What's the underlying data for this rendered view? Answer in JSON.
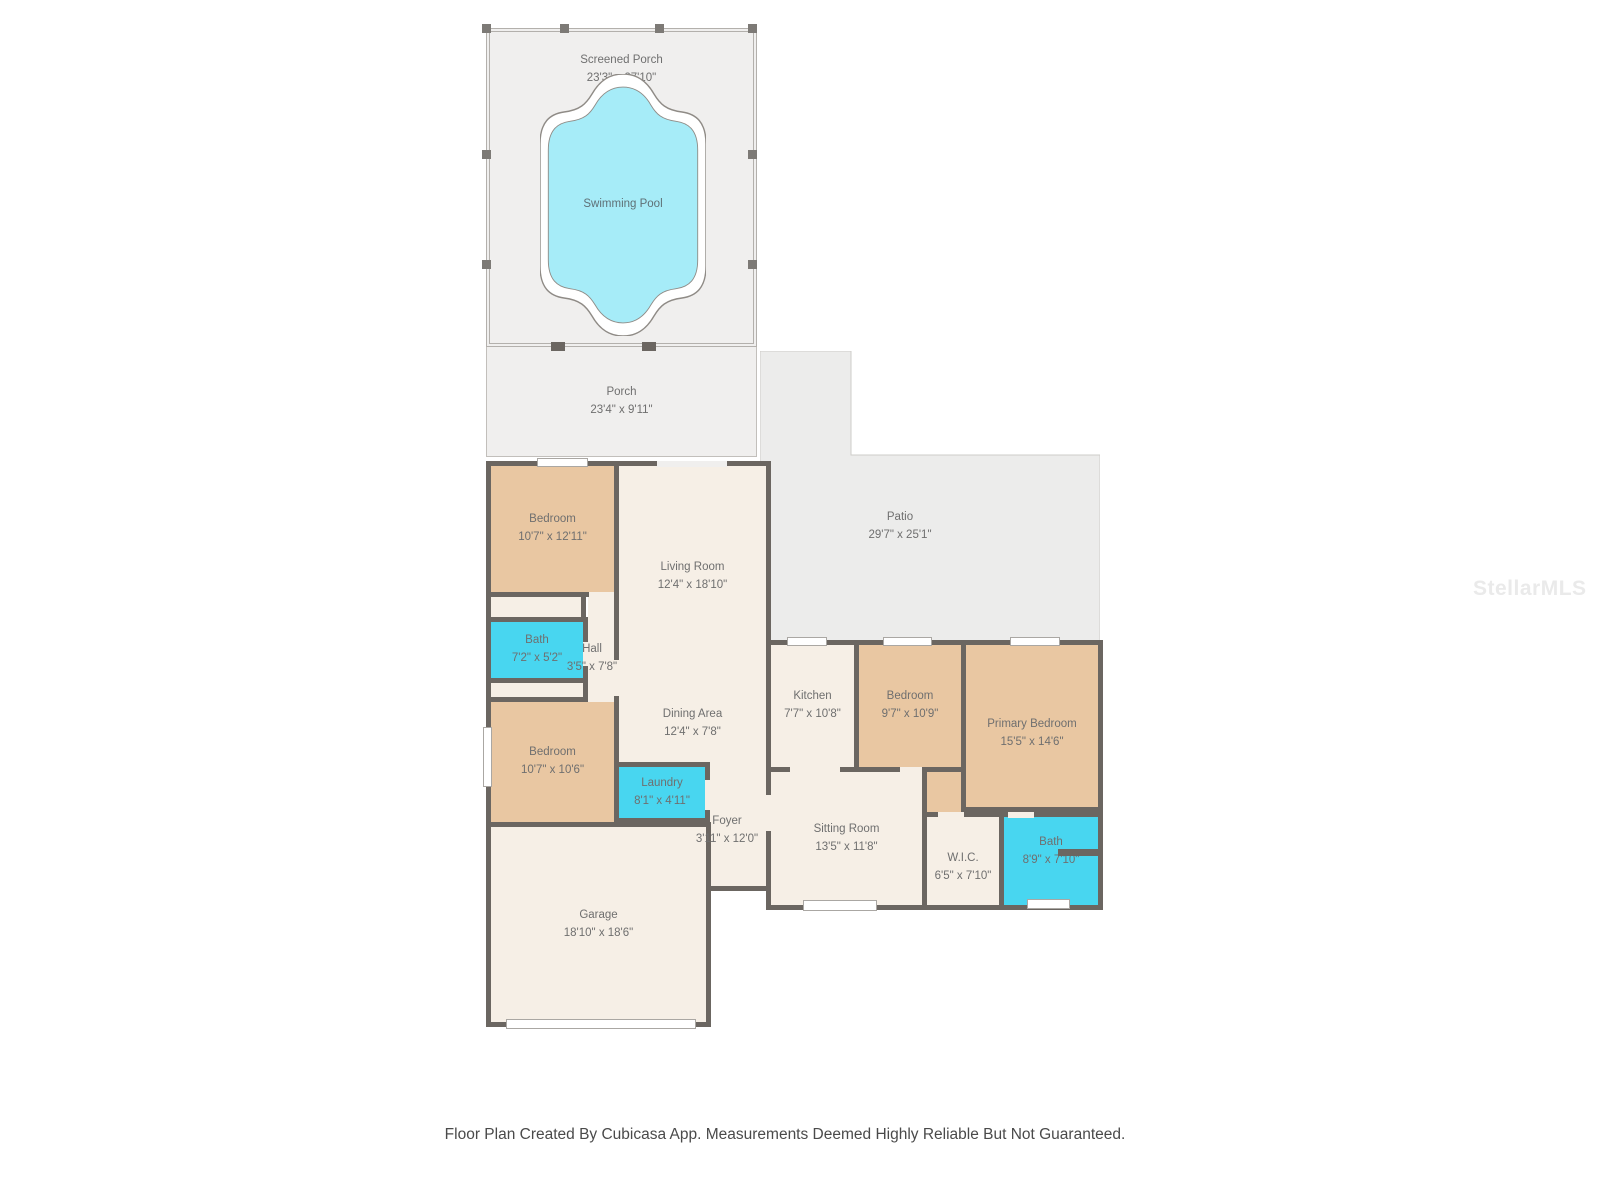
{
  "title": "Floor Plan",
  "palette": {
    "wall": "#6b6661",
    "bedroom_fill": "#e9c7a2",
    "floor_fill": "#f6efe6",
    "wet_room_fill": "#48d6f0",
    "pool_fill": "#a6ecf8",
    "outdoor_fill": "#ececeb",
    "porch_fill": "#f0efee"
  },
  "rooms": {
    "screened_porch": {
      "name": "Screened Porch",
      "dims": "23'3\" x 27'10\""
    },
    "swimming_pool": {
      "name": "Swimming Pool",
      "dims": ""
    },
    "porch": {
      "name": "Porch",
      "dims": "23'4\" x 9'11\""
    },
    "patio": {
      "name": "Patio",
      "dims": "29'7\" x 25'1\""
    },
    "bedroom_top": {
      "name": "Bedroom",
      "dims": "10'7\" x 12'11\""
    },
    "living_room": {
      "name": "Living Room",
      "dims": "12'4\" x 18'10\""
    },
    "bath_1": {
      "name": "Bath",
      "dims": "7'2\" x 5'2\""
    },
    "hall": {
      "name": "Hall",
      "dims": "3'5\" x 7'8\""
    },
    "bedroom_mid": {
      "name": "Bedroom",
      "dims": "10'7\" x 10'6\""
    },
    "dining_area": {
      "name": "Dining Area",
      "dims": "12'4\" x 7'8\""
    },
    "laundry": {
      "name": "Laundry",
      "dims": "8'1\" x 4'11\""
    },
    "foyer": {
      "name": "Foyer",
      "dims": "3'11\" x 12'0\""
    },
    "kitchen": {
      "name": "Kitchen",
      "dims": "7'7\" x 10'8\""
    },
    "bedroom_right": {
      "name": "Bedroom",
      "dims": "9'7\" x 10'9\""
    },
    "primary_bedroom": {
      "name": "Primary Bedroom",
      "dims": "15'5\" x 14'6\""
    },
    "sitting_room": {
      "name": "Sitting Room",
      "dims": "13'5\" x 11'8\""
    },
    "wic": {
      "name": "W.I.C.",
      "dims": "6'5\" x 7'10\""
    },
    "bath_2": {
      "name": "Bath",
      "dims": "8'9\" x 7'10\""
    },
    "garage": {
      "name": "Garage",
      "dims": "18'10\" x 18'6\""
    }
  },
  "watermark": {
    "text": "StellarMLS"
  },
  "footer": {
    "text": "Floor Plan Created By Cubicasa App. Measurements Deemed Highly Reliable But Not Guaranteed."
  }
}
